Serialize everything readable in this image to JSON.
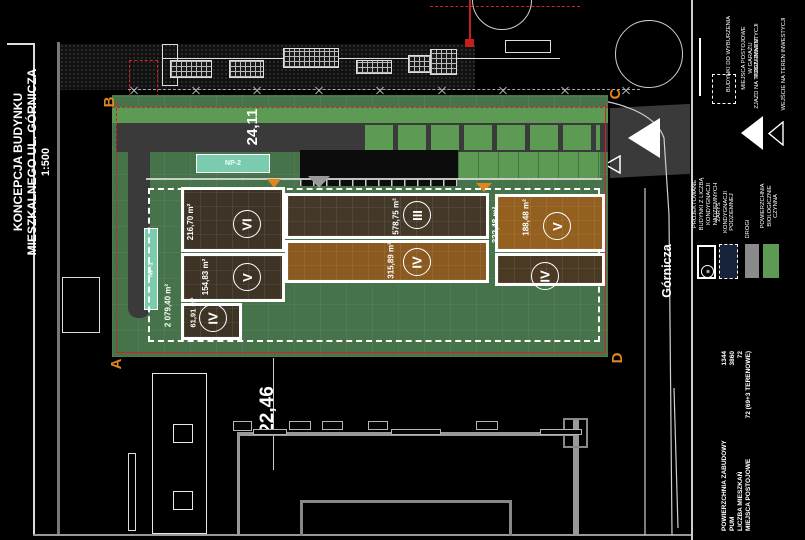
{
  "title": {
    "line1": "KONCEPCJA BUDYNKU",
    "line2": "MIESZKALNEGO UL. GÓRNICZA",
    "scale": "1:500"
  },
  "street_label": "Górnicza",
  "corner_markers": {
    "a": "A",
    "b": "B",
    "c": "C",
    "d": "D"
  },
  "dimensions": {
    "top": "24,11",
    "bottom": "22,46"
  },
  "underground_garage_area": "2 079,40 m²",
  "parking_bays": {
    "np1": "NP-1",
    "np2": "NP-2"
  },
  "buildings": [
    {
      "storeys": "VI",
      "area": "216,70 m²"
    },
    {
      "storeys": "III",
      "area": "578,75 m²"
    },
    {
      "storeys": "V",
      "area": "154,83 m²"
    },
    {
      "storeys": "IV",
      "area": "315,89 m²"
    },
    {
      "storeys": "IV",
      "area": "61,91 m²"
    },
    {
      "storeys": "V",
      "area": "188,48 m²"
    },
    {
      "storeys": "IV",
      "area": "332,48 m²"
    }
  ],
  "legend": {
    "items": [
      {
        "label": "PROJEKTOWANE BUDYNKI Z LICZBĄ KONDYGNACJI NADZIEMNYCH",
        "icon": "building-outline-rect",
        "icon_storeys": "III"
      },
      {
        "label": "ZARYS KONDYGNACJI PODZIEMNEJ",
        "icon": "dashed-navy-rect"
      },
      {
        "label": "DROGI",
        "icon": "gray-rect"
      },
      {
        "label": "POWIERZCHNIA BIOLOGICZNIE CZYNNA",
        "icon": "green-rect"
      },
      {
        "label": "BUDYNKI DO WYBURZENIA",
        "icon": "demolition-line"
      },
      {
        "label": "MIEJSCA POSTOJOWE W GARAŻU PODZIEMNYM",
        "icon": "dashed-outline-rect"
      },
      {
        "label": "ZJAZD NA TEREN INWESTYCJI",
        "icon": "filled-triangle"
      },
      {
        "label": "WEJŚCIE NA TEREN INWESTYCJI",
        "icon": "outline-triangle"
      }
    ]
  },
  "stats": {
    "rows": [
      {
        "label": "POWIERZCHNIA ZABUDOWY",
        "value": "1344"
      },
      {
        "label": "PUM",
        "value": "3860"
      },
      {
        "label": "LICZBA MIESZKAŃ",
        "value": "72"
      },
      {
        "label": "MIEJSCA POSTOJOWE",
        "value": "72 (69+3 TERENOWE)"
      }
    ]
  },
  "colors": {
    "background": "#000000",
    "site_green": "#47734a",
    "lawn_green": "#5d9b55",
    "parking_teal": "#7bcbae",
    "building_dark_brown": "#3e3426",
    "building_light_brown": "#8a5a20",
    "road_gray": "#3a3a3a",
    "boundary_red": "#d22222",
    "marker_orange": "#e0861f",
    "underground_navy": "#17233a"
  }
}
